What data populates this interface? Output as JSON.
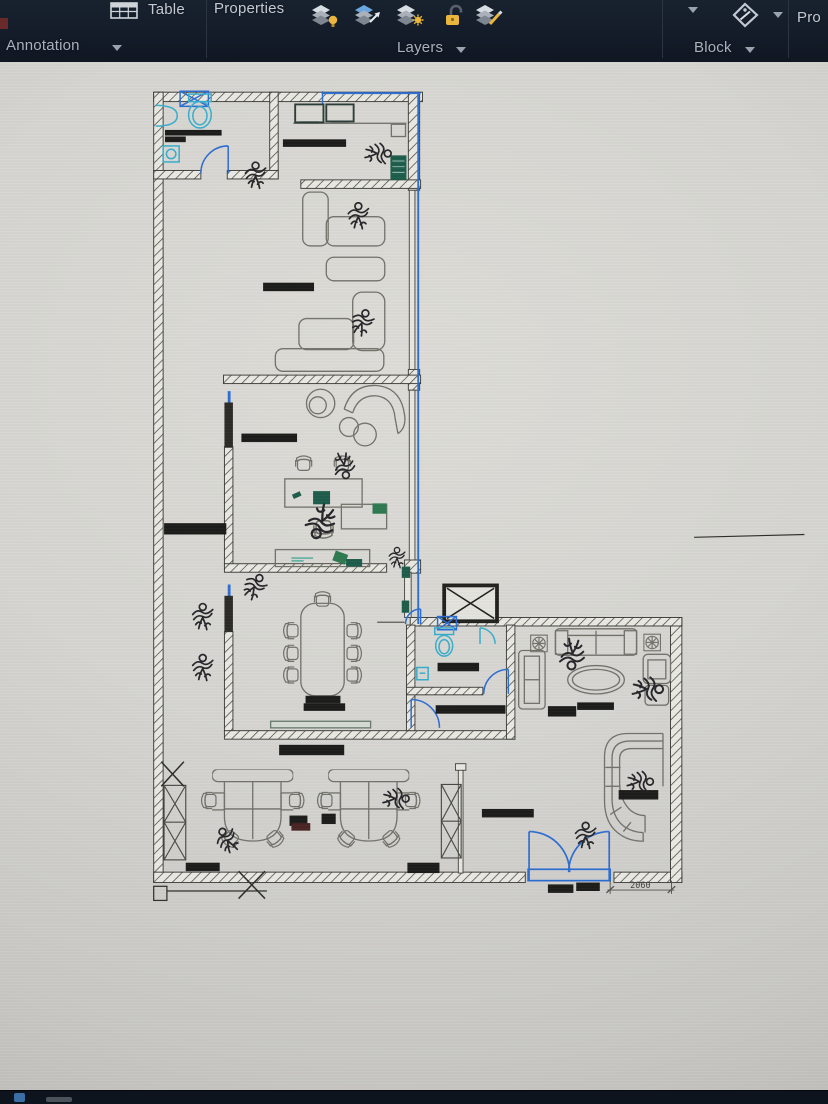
{
  "ribbon": {
    "table_button": "Table",
    "properties_button": "Properties",
    "panel_annotation": "Annotation",
    "panel_layers": "Layers",
    "panel_block": "Block",
    "panel_properties_partial": "Pro",
    "layer_tools": [
      "layer-on",
      "layer-match",
      "layer-thaw",
      "layer-unlock",
      "layer-edit"
    ]
  },
  "drawing": {
    "dimension_text": "2060"
  },
  "colors": {
    "toolbar_bg": "#141c29",
    "canvas_bg": "#d6d5d1",
    "wall_line": "#3c3c38",
    "furniture_gray": "#73736c",
    "accent_blue": "#2e6ed2",
    "fixture_cyan": "#39aecb",
    "equipment_teal": "#1d5c4b",
    "highlight_yellow": "#eab63e"
  }
}
